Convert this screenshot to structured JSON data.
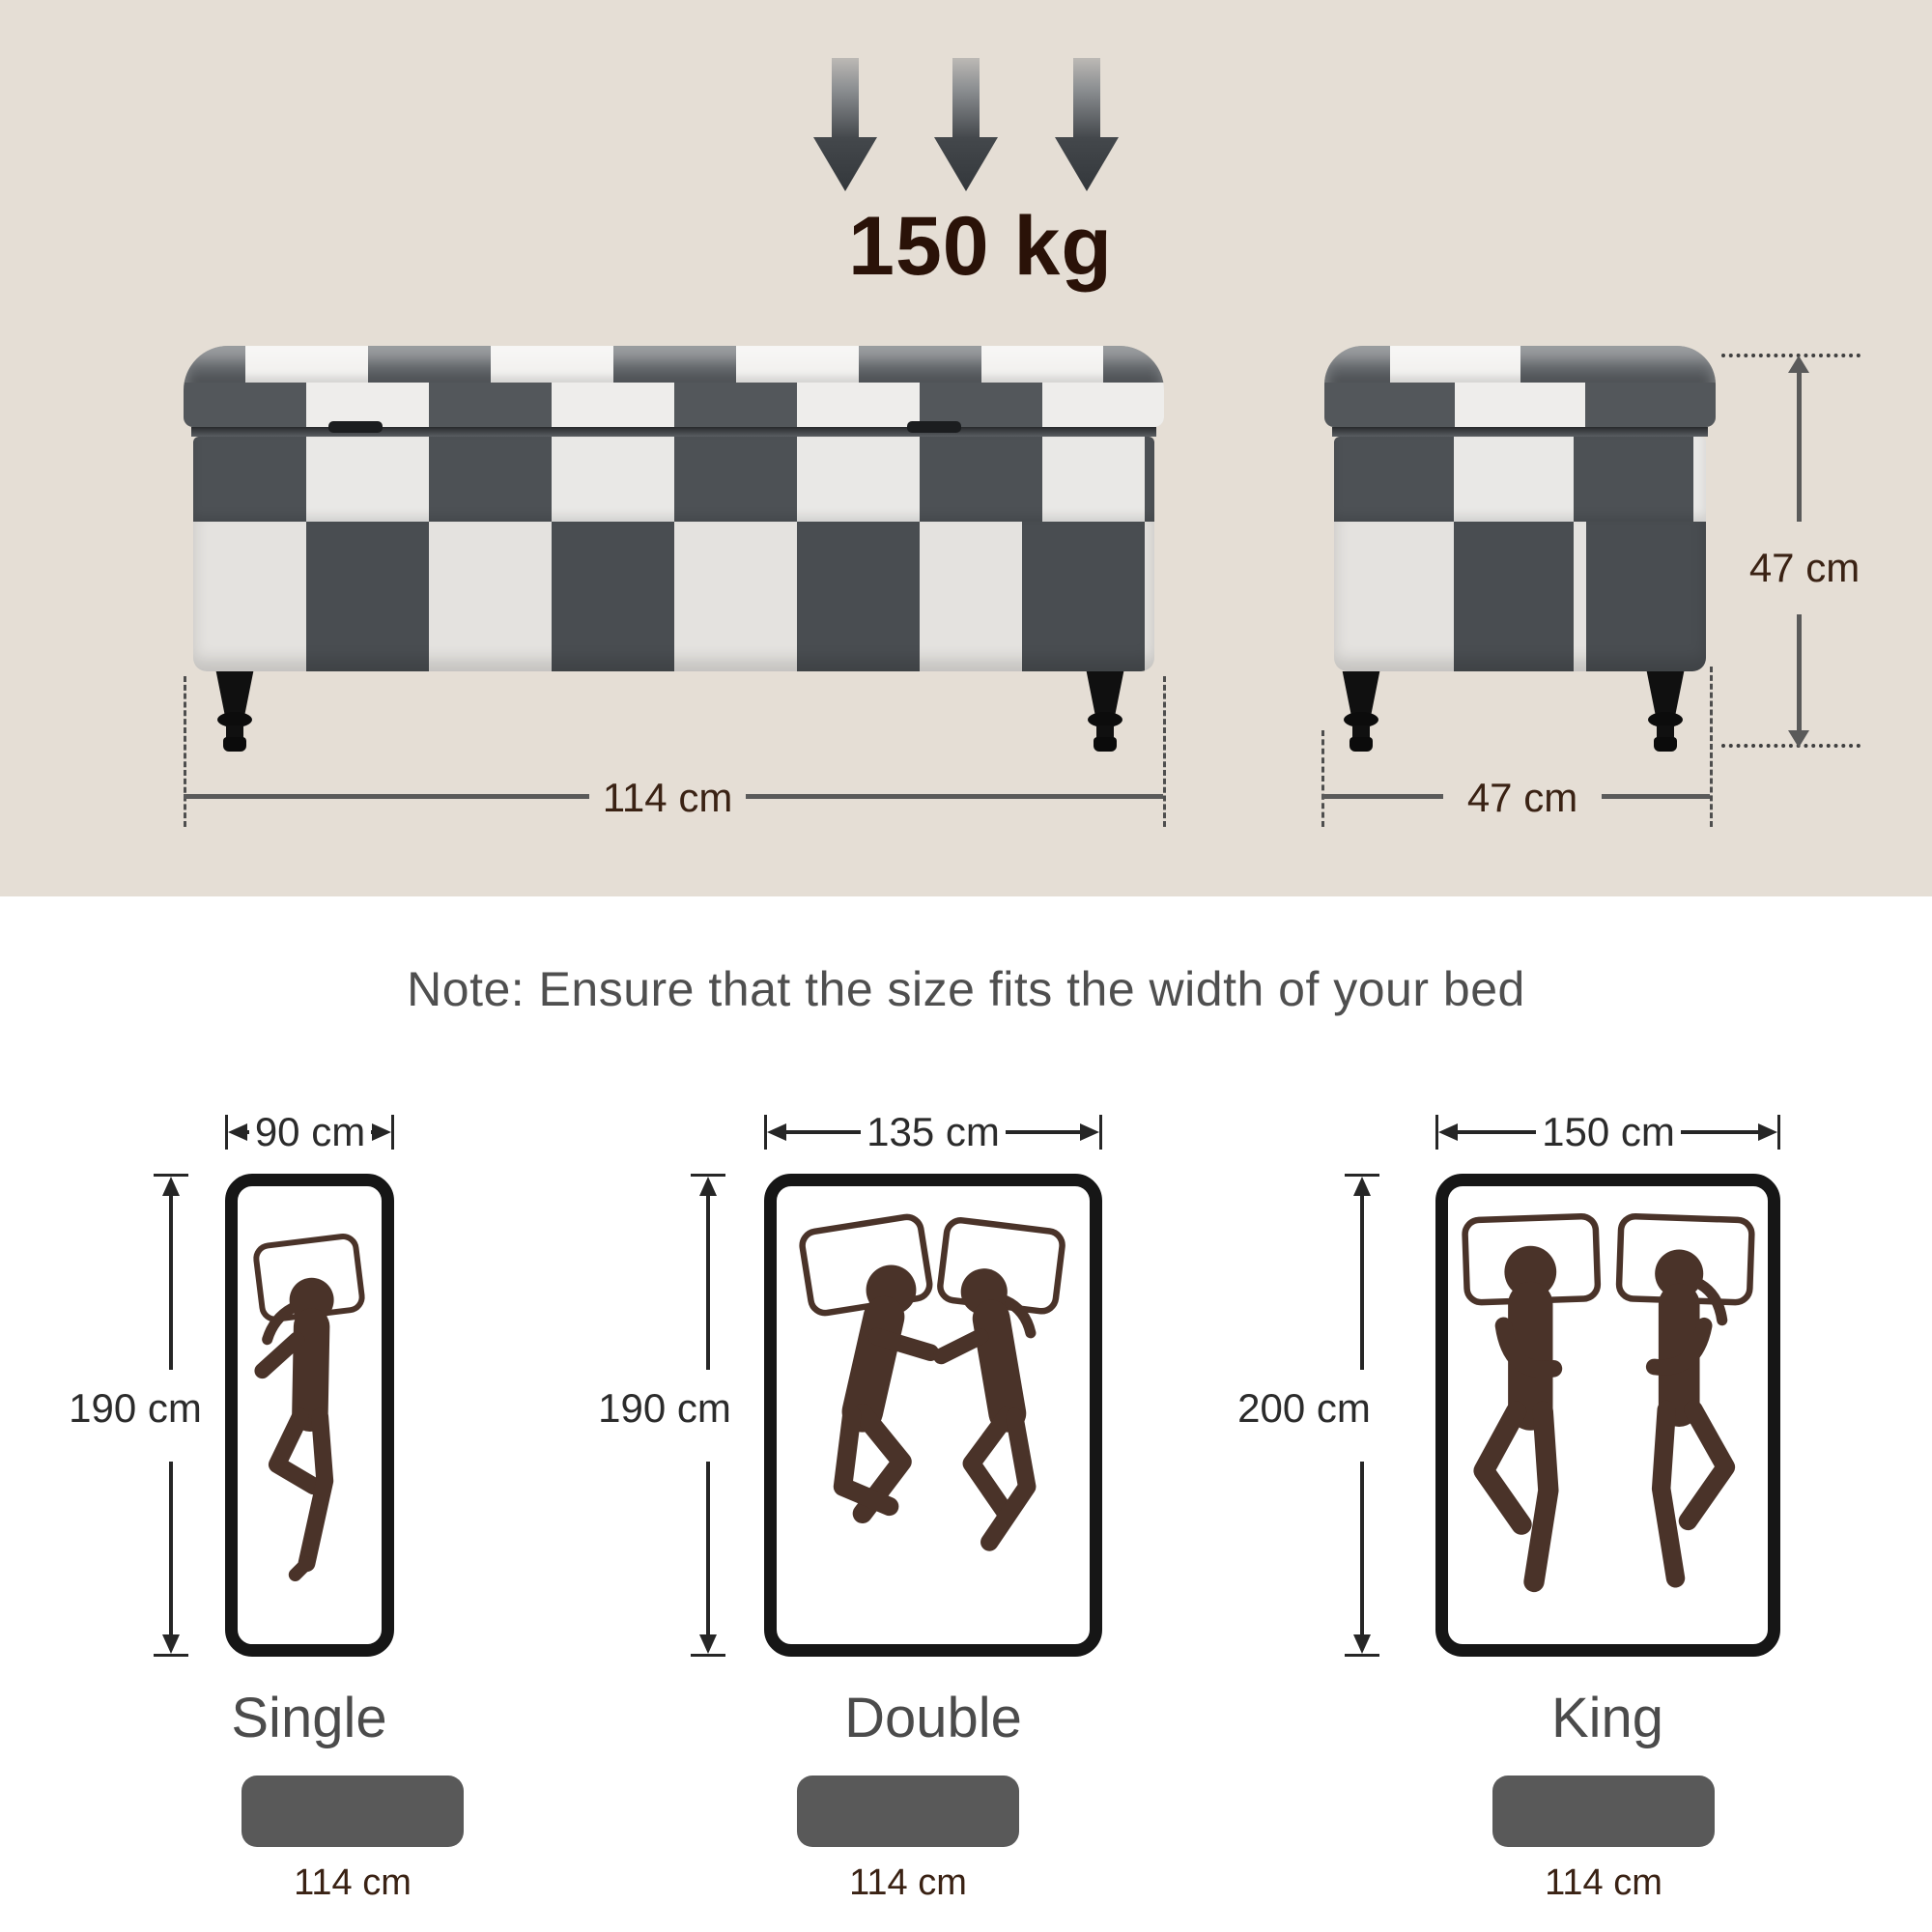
{
  "load": {
    "label": "150 kg"
  },
  "front_view": {
    "width_label": "114 cm"
  },
  "side_view": {
    "depth_label": "47 cm",
    "height_label": "47 cm"
  },
  "note": {
    "text": "Note: Ensure that the size fits the width of your bed"
  },
  "beds": [
    {
      "name": "Single",
      "width_label": "90 cm",
      "length_label": "190 cm",
      "occupants": 1,
      "bench_width_label": "114 cm"
    },
    {
      "name": "Double",
      "width_label": "135 cm",
      "length_label": "190 cm",
      "occupants": 2,
      "bench_width_label": "114 cm"
    },
    {
      "name": "King",
      "width_label": "150 cm",
      "length_label": "200 cm",
      "occupants": 2,
      "bench_width_label": "114 cm"
    }
  ],
  "colors": {
    "beige_panel": "#e5ded5",
    "bench_dark": "#4d5155",
    "bench_white": "#eceae7",
    "leg_black": "#101010",
    "dim_line_gray": "#5a5a5a",
    "dim_text_brown": "#3a2214",
    "bed_dim_black": "#262626",
    "figure_brown": "#4a3329",
    "bar_gray": "#595959",
    "note_gray": "#4f4f4f",
    "load_text": "#2a1208"
  }
}
